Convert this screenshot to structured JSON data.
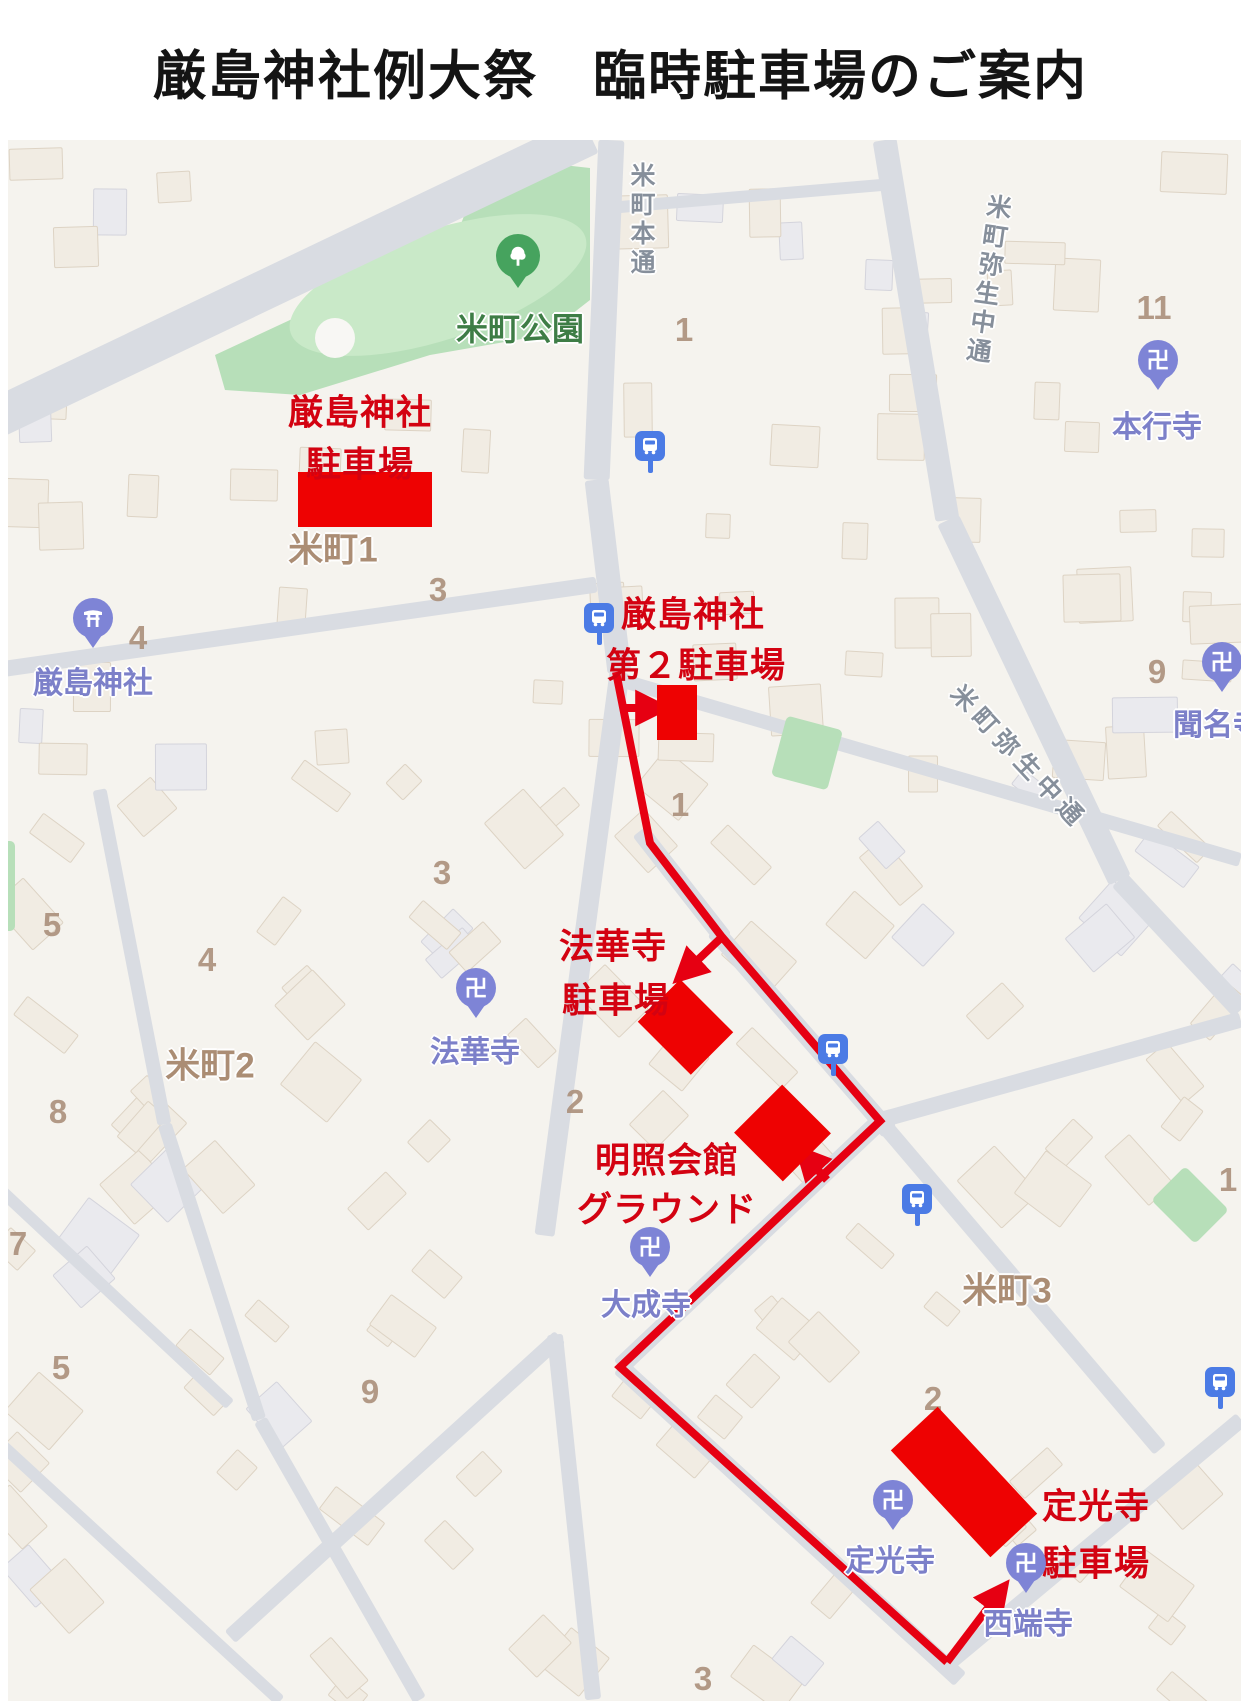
{
  "title": "厳島神社例大祭　臨時駐車場のご案内",
  "map": {
    "parking_labels": {
      "itsukushima": {
        "line1": "厳島神社",
        "line2": "駐車場"
      },
      "itsukushima2": {
        "line1": "厳島神社",
        "line2": "第２駐車場"
      },
      "hokkeji": {
        "line1": "法華寺",
        "line2": "駐車場"
      },
      "meisho": {
        "line1": "明照会館",
        "line2": "グラウンド"
      },
      "jokoji": {
        "line1": "定光寺",
        "line2": "駐車場"
      }
    },
    "places": {
      "park": "米町公園",
      "itsukushima_shrine": "厳島神社",
      "hongyoji": "本行寺",
      "monmyoji": "聞名寺",
      "hokkeji": "法華寺",
      "taiseiji": "大成寺",
      "jokoji": "定光寺",
      "seitanji": "西端寺"
    },
    "streets": {
      "komachi_hondori": "米町本通",
      "yayoi_naka_north": "米町弥生中通",
      "yayoi_naka_south": "米町弥生中通"
    },
    "districts": {
      "komachi1": "米町1",
      "komachi2": "米町2",
      "komachi3": "米町3"
    },
    "blocks": {
      "b1a": "1",
      "b1b": "1",
      "b1c": "1",
      "b2a": "2",
      "b2b": "2",
      "b3a": "3",
      "b3b": "3",
      "b3c": "3",
      "b4a": "4",
      "b4b": "4",
      "b5a": "5",
      "b5b": "5",
      "b7": "7",
      "b8": "8",
      "b9a": "9",
      "b9b": "9",
      "b11": "11"
    },
    "icons": {
      "temple_glyph": "卍"
    },
    "colors": {
      "route_red": "#e60012",
      "parking_fill": "#ee0202",
      "red_label": "#d30211",
      "temple_purple": "#7e84d6",
      "label_purple": "#7c80c9",
      "park_green": "#b7dfb9",
      "park_label_green": "#3e7d46",
      "district_brown": "#a8886e",
      "street_gray": "#868f9b",
      "bus_blue": "#4b7be5"
    }
  }
}
